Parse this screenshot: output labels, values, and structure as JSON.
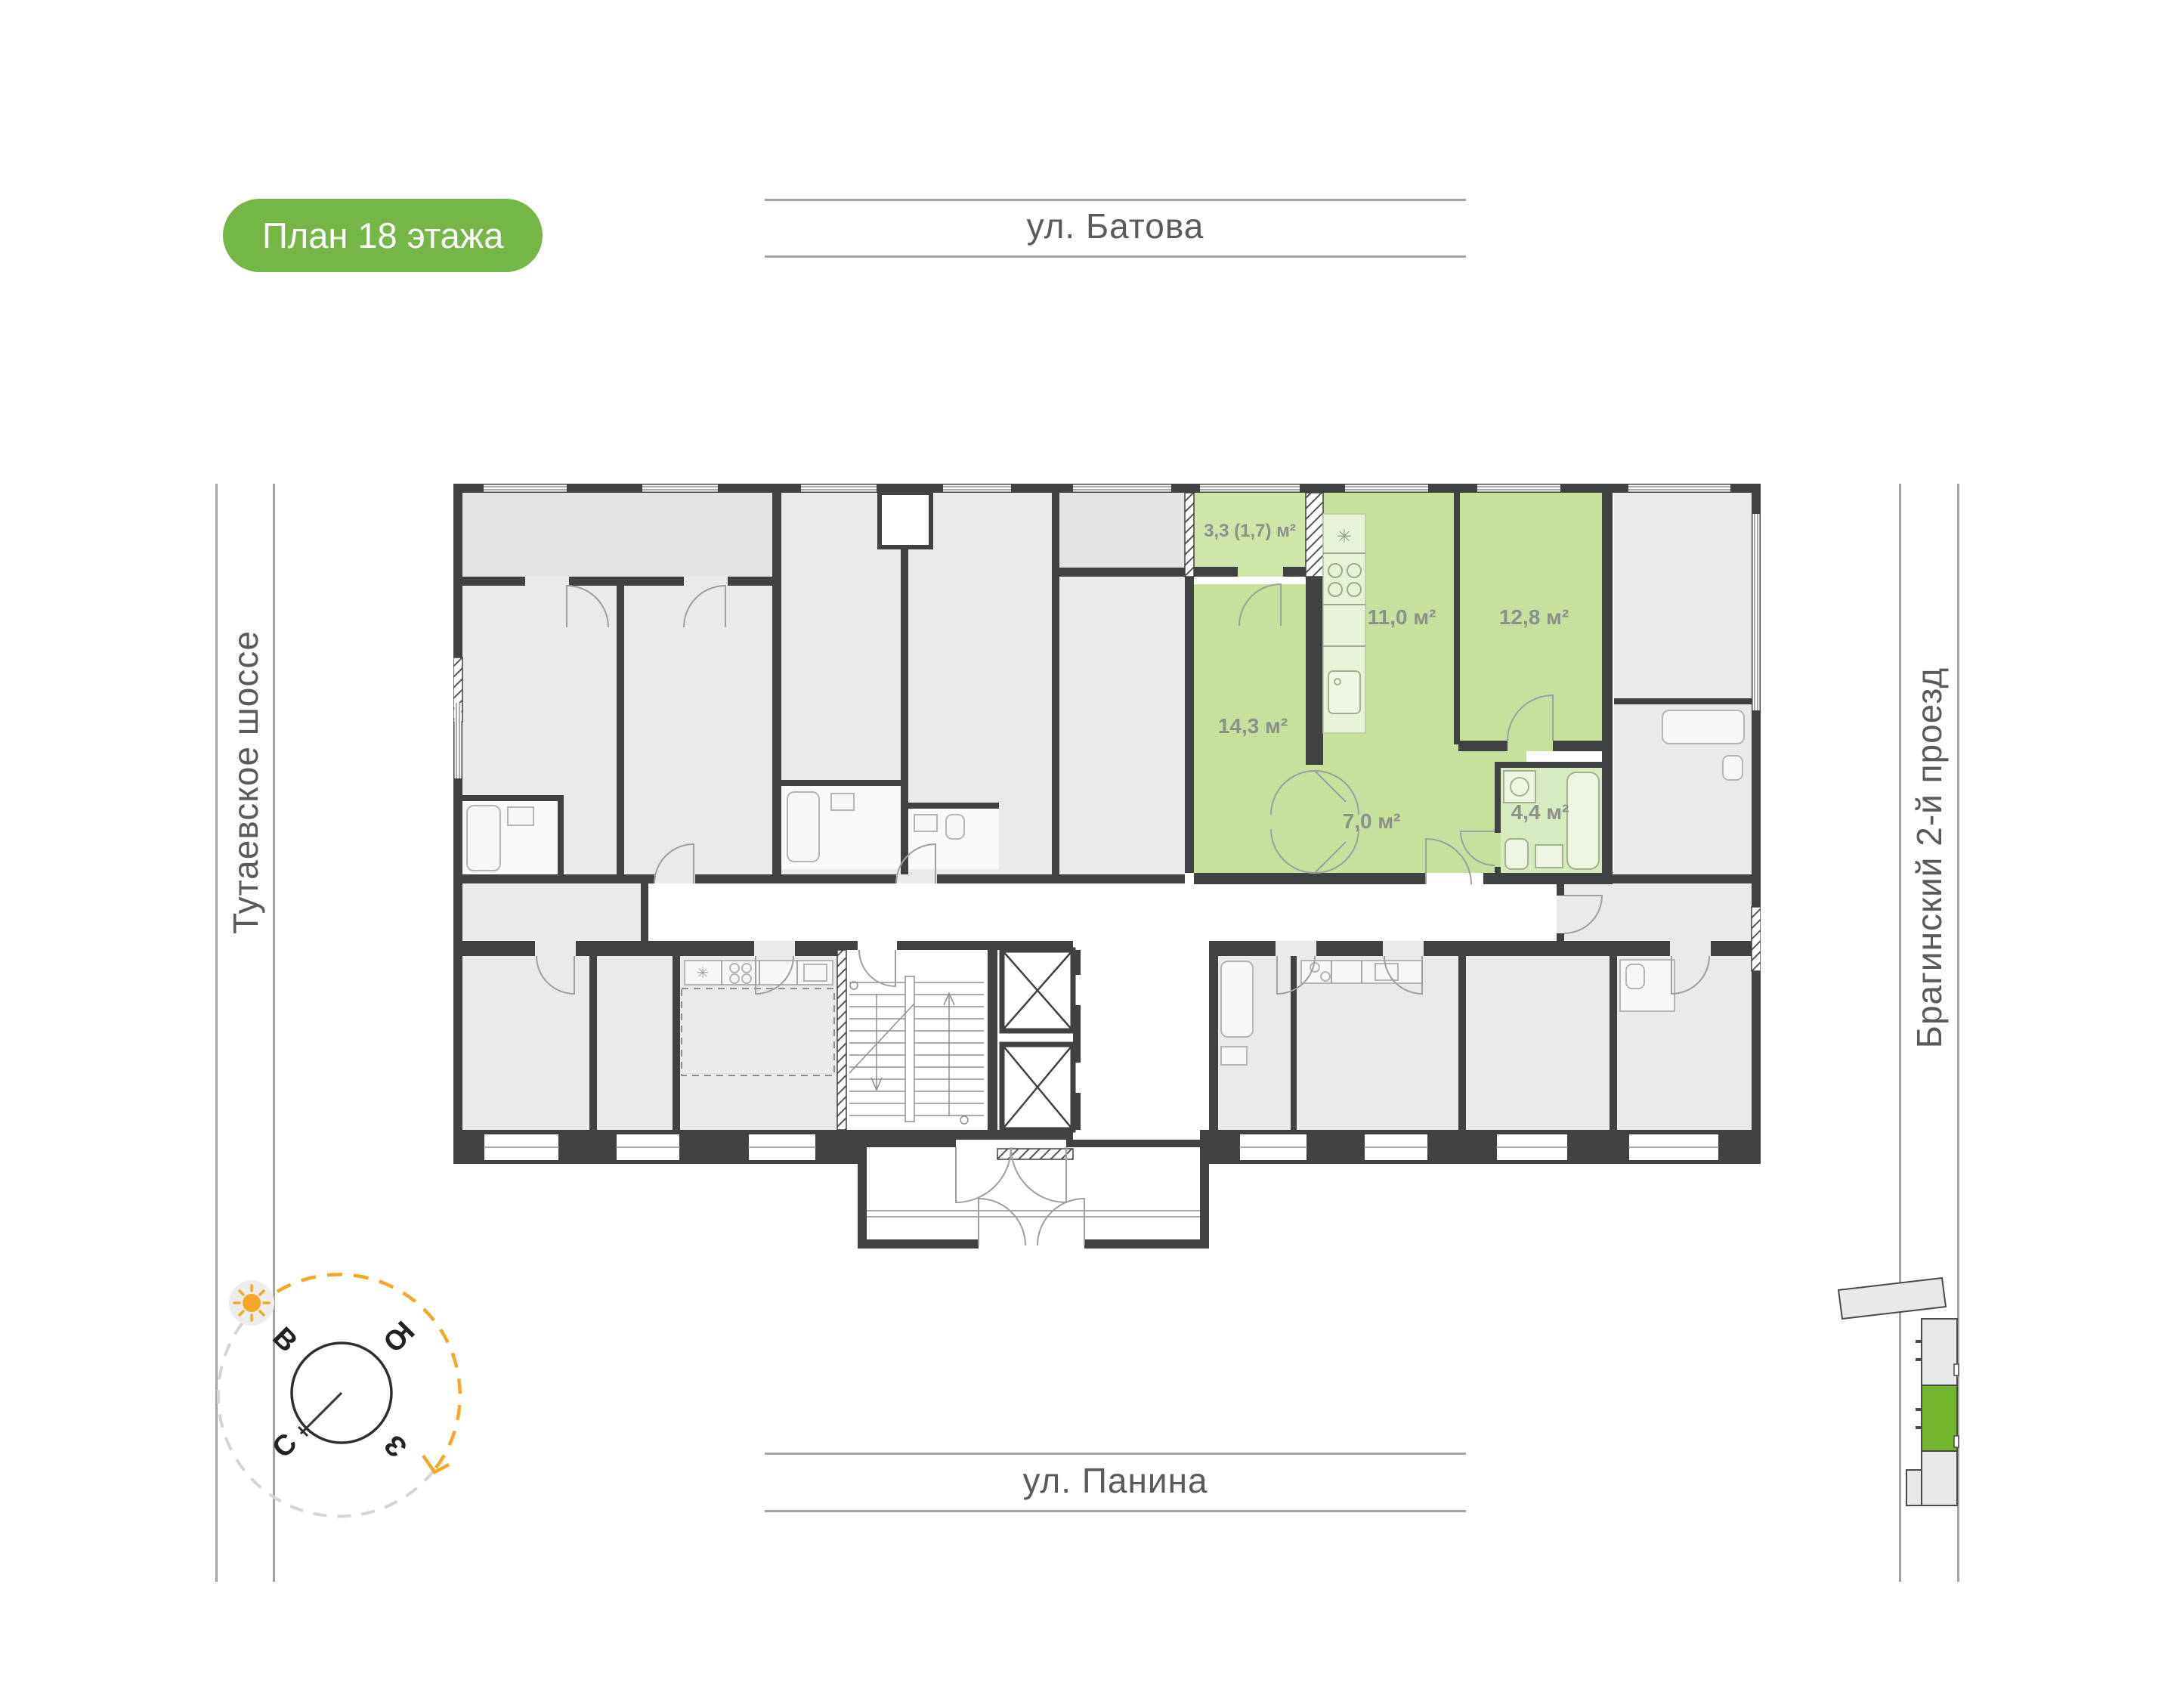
{
  "title_badge": {
    "label": "План 18 этажа",
    "bg": "#74b746",
    "text_color": "#ffffff"
  },
  "streets": {
    "top": "ул. Батова",
    "bottom": "ул. Панина",
    "left": "Тутаевское шоссе",
    "right": "Брагинский 2-й проезд"
  },
  "floor_plan": {
    "wall_color": "#3f4142",
    "room_fill": "#e9eaeb",
    "highlighted_apartment": {
      "highlight_color": "#c6e19c",
      "rooms": [
        {
          "name": "balcony",
          "area_label": "3,3 (1,7) м²"
        },
        {
          "name": "kitchen",
          "area_label": "11,0 м²"
        },
        {
          "name": "bedroom",
          "area_label": "12,8 м²"
        },
        {
          "name": "living-room",
          "area_label": "14,3 м²"
        },
        {
          "name": "hallway",
          "area_label": "7,0 м²"
        },
        {
          "name": "bathroom",
          "area_label": "4,4 м²"
        }
      ]
    }
  },
  "icons": {
    "fridge_snowflake": "✳"
  },
  "compass": {
    "east": "В",
    "south": "Ю",
    "north": "С",
    "west": "З",
    "sun_color": "#f6a728",
    "circle_color": "#2f2f2f"
  },
  "minimap": {
    "highlight_color": "#72b62e",
    "outline_color": "#4a4a4a"
  }
}
